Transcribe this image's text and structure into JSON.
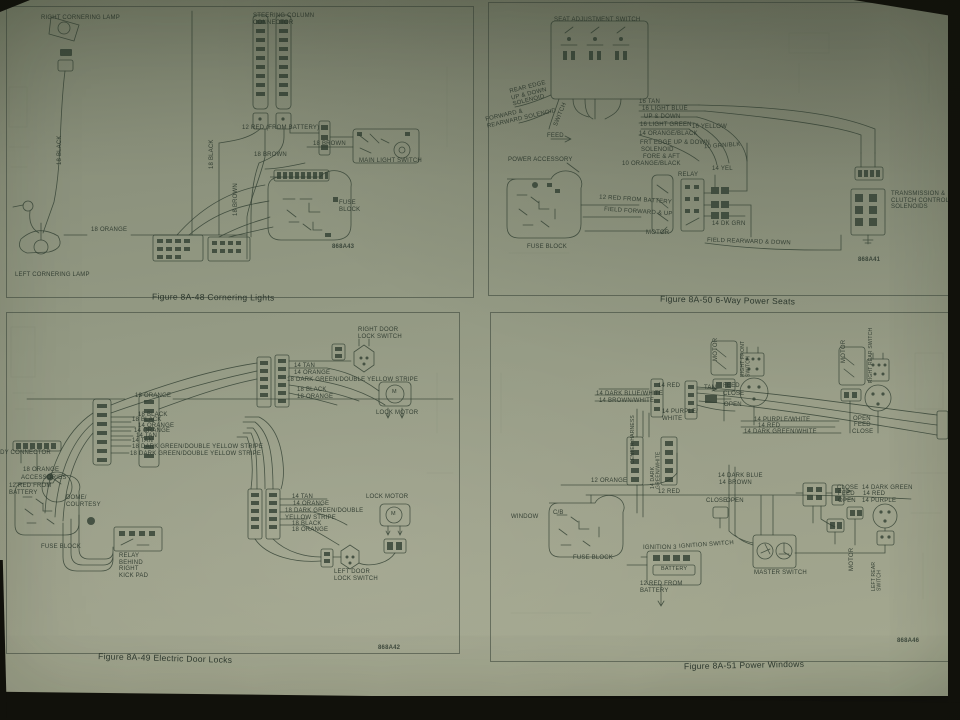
{
  "colors": {
    "paper": "#9aa089",
    "ink": "#36422f",
    "photo_background": "#14140e"
  },
  "figures": [
    {
      "caption": "Figure 8A-48 Cornering Lights",
      "part_number": "868A43",
      "labels": {
        "right_cornering_lamp": "RIGHT CORNERING LAMP",
        "steering_column_connector": "STEERING COLUMN\nCONNECTOR",
        "wire_12_red": "12 RED (FROM BATTERY)",
        "wire_18_brown_a": "18 BROWN",
        "wire_18_brown_b": "18 BROWN",
        "wire_18_brown_vertical": "18 BROWN",
        "wire_18_black_vertical_left": "18 BLACK",
        "wire_18_black_vertical_mid": "18 BLACK",
        "wire_18_orange_vertical_mid": "18 ORANGE",
        "main_light_switch": "MAIN LIGHT SWITCH",
        "fuse_block": "FUSE\nBLOCK",
        "wire_18_orange": "18 ORANGE",
        "left_cornering_lamp": "LEFT CORNERING LAMP"
      }
    },
    {
      "caption": "Figure 8A-50 6-Way Power Seats",
      "part_number": "868A41",
      "labels": {
        "seat_adjustment_switch": "SEAT ADJUSTMENT SWITCH",
        "rear_edge_solenoid": "REAR EDGE\nUP & DOWN\nSOLENOID",
        "forward_rearward_solenoid": "FORWARD &\nREARWARD SOLENOID",
        "switch": "SWITCH",
        "feed": "FEED",
        "wire_16_tan": "16 TAN",
        "wire_16_light_blue": "16 LIGHT BLUE",
        "up_down": "UP & DOWN",
        "wire_16_light_green": "16 LIGHT GREEN",
        "wire_16_yellow": "16 YELLOW",
        "wire_14_orange_black": "14 ORANGE/BLACK",
        "frt_edge_up_down": "FRT EDGE UP & DOWN",
        "solenoid": "SOLENOID",
        "fore_aft": "FORE & AFT",
        "wire_10_orange_black": "10 ORANGE/BLACK",
        "wire_10_grn_blk": "10 GRN/BLK",
        "power_accessory": "POWER ACCESSORY",
        "relay": "RELAY",
        "wire_14_yel": "14 YEL",
        "wire_12_red_from_battery": "12 RED FROM BATTERY",
        "field_forward_up": "FIELD FORWARD & UP",
        "motor": "MOTOR",
        "wire_14_dk_grn": "14 DK GRN",
        "field_rearward_down": "FIELD REARWARD & DOWN",
        "fuse_block": "FUSE BLOCK",
        "transmission_solenoids": "TRANSMISSION &\nCLUTCH CONTROL\nSOLENOIDS"
      }
    },
    {
      "caption": "Figure 8A-49 Electric Door Locks",
      "part_number": "868A42",
      "labels": {
        "right_door_lock_switch": "RIGHT DOOR\nLOCK SWITCH",
        "wire_14_tan_top": "14 TAN",
        "wire_14_orange_top": "14 ORANGE",
        "wire_18_dkgrn_top": "18 DARK GREEN/DOUBLE YELLOW STRIPE",
        "wire_18_black_top": "18 BLACK",
        "wire_18_orange_top": "18 ORANGE",
        "lock_motor_top": "LOCK MOTOR",
        "motor_m_top": "M",
        "wire_18_orange_line": "18 ORANGE",
        "bundle": [
          "18 BLACK",
          "18 BLACK",
          "14 ORANGE",
          "14 ORANGE",
          "14 TAN",
          "14 TAN",
          "18 DARK GREEN/DOUBLE YELLOW STRIPE",
          "18 DARK GREEN/DOUBLE YELLOW STRIPE"
        ],
        "body_connector": "BODY CONNECTOR",
        "wire_18_orange_acc": "18 ORANGE",
        "accessories": "ACCESSORIES",
        "red_from_battery": "12 RED FROM\nBATTERY",
        "dome_courtesy": "DOME/\nCOURTESY",
        "fuse_block": "FUSE BLOCK",
        "relay_kick_pad": "RELAY\nBEHIND\nRIGHT\nKICK PAD",
        "wire_14_tan_mid": "14 TAN",
        "wire_14_orange_mid": "14 ORANGE",
        "wire_18_dkgrn_mid": "18 DARK GREEN/DOUBLE\nYELLOW STRIPE",
        "wire_18_black_mid": "18 BLACK",
        "wire_18_orange_mid": "18 ORANGE",
        "lock_motor_mid": "LOCK MOTOR",
        "motor_m_mid": "M",
        "left_door_lock_switch": "LEFT DOOR\nLOCK SWITCH"
      }
    },
    {
      "caption": "Figure 8A-51 Power Windows",
      "part_number": "868A46",
      "labels": {
        "motor_top_left": "MOTOR",
        "right_front_switch": "RIGHT FRONT SWITCH",
        "motor_top_right": "MOTOR",
        "right_rear_switch": "RIGHT REAR SWITCH",
        "wire_14_red_a": "14 RED",
        "wire_14_dark_blue_white": "14 DARK BLUE/WHITE",
        "wire_14_brown_white": "14 BROWN/WHITE",
        "wire_14_purple_white_a": "14 PURPLE/\nWHITE",
        "tan": "TAN",
        "feed_a": "FEED",
        "close_a": "CLOSE",
        "open_a": "OPEN",
        "center_harness": "CENTER HARNESS",
        "wire_14_dark_green_white_v": "14 DARK GREEN/WHITE",
        "wire_14_purple_white_b": "14 PURPLE/WHITE",
        "wire_14_red_b": "14 RED",
        "wire_14_dark_green_white_b": "14 DARK GREEN/WHITE",
        "open_b": "OPEN",
        "feed_b": "FEED",
        "close_b": "CLOSE",
        "wire_14_dark_blue": "14 DARK BLUE",
        "wire_14_brown": "14 BROWN",
        "wire_12_orange": "12 ORANGE",
        "wire_12_red": "12 RED",
        "window": "WINDOW",
        "cb": "C/B",
        "fuse_block": "FUSE BLOCK",
        "close_c": "CLOSE",
        "open_c": "OPEN",
        "ignition_3": "IGNITION 3",
        "ignition_switch": "IGNITION SWITCH",
        "battery": "BATTERY",
        "red_from_battery": "12 RED FROM\nBATTERY",
        "master_switch": "MASTER SWITCH",
        "close_d": "CLOSE",
        "feed_d": "FEED",
        "open_d": "OPEN",
        "wire_14_dark_green": "14 DARK GREEN",
        "wire_14_red_c": "14 RED",
        "wire_14_purple": "14 PURPLE",
        "motor_bottom": "MOTOR",
        "left_rear_switch": "LEFT REAR\nSWITCH"
      }
    }
  ]
}
